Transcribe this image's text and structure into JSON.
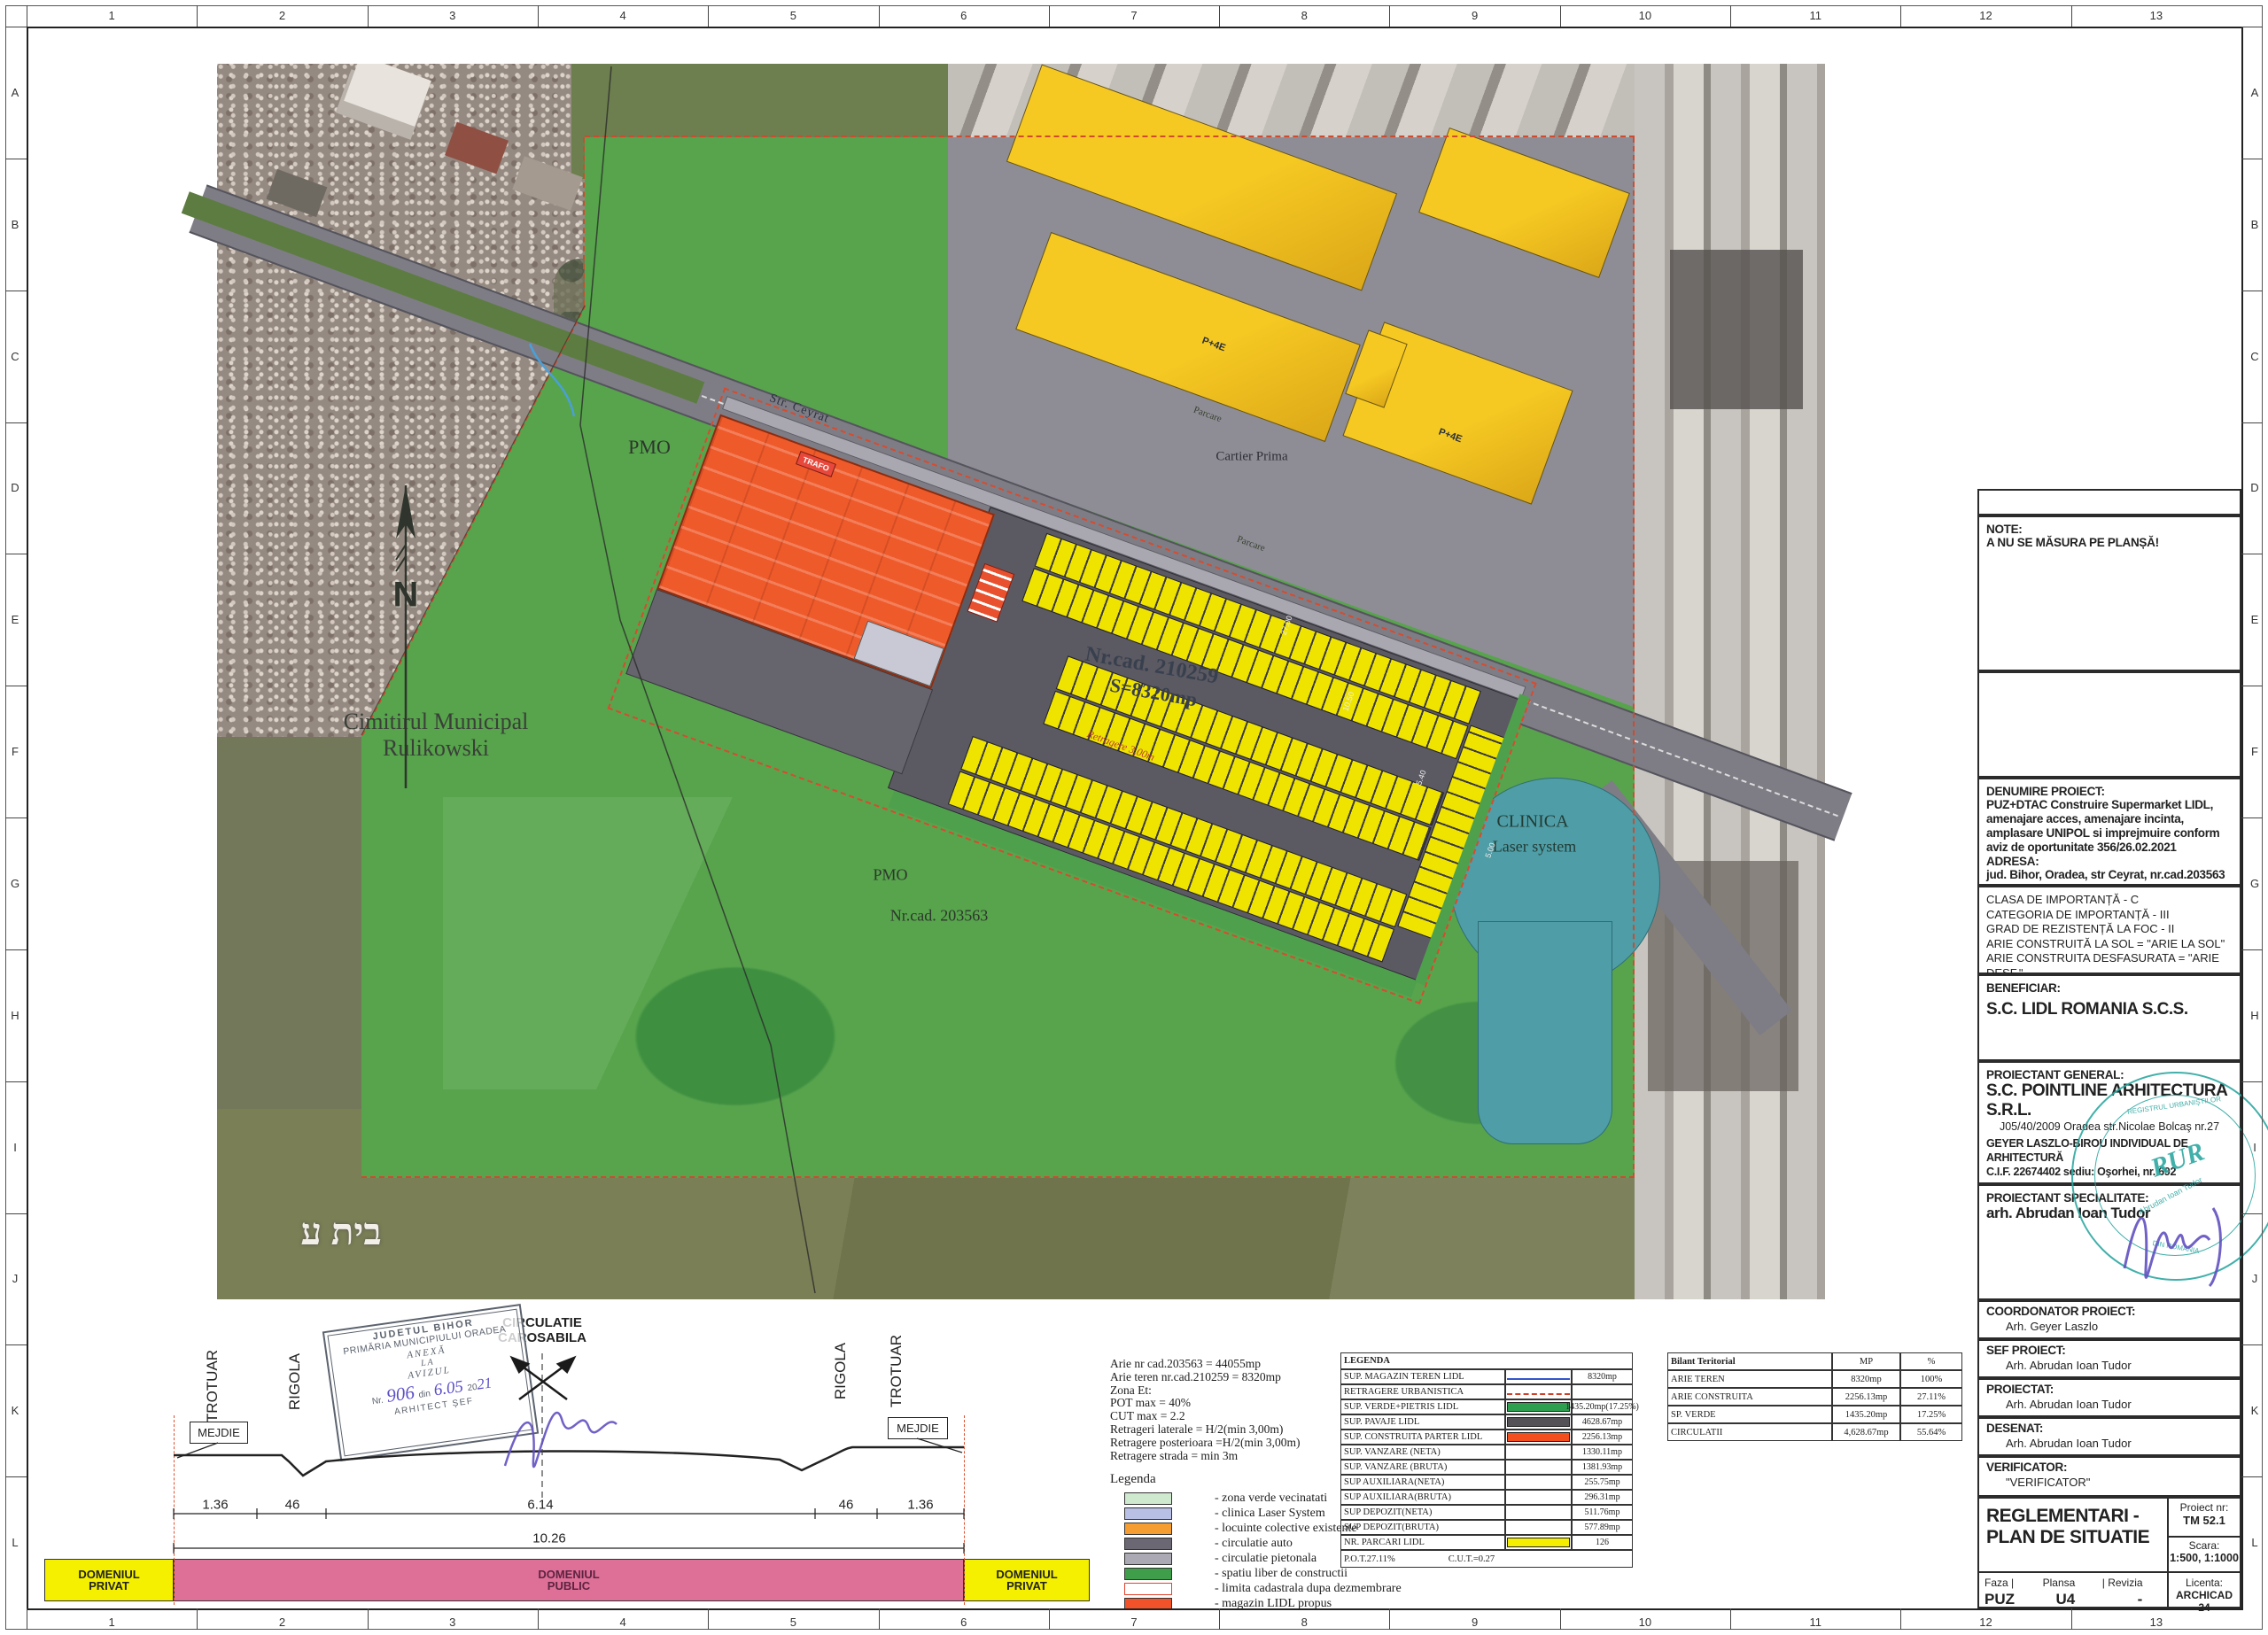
{
  "frame": {
    "columns": [
      "1",
      "2",
      "3",
      "4",
      "5",
      "6",
      "7",
      "8",
      "9",
      "10",
      "11",
      "12",
      "13"
    ],
    "rows": [
      "A",
      "B",
      "C",
      "D",
      "E",
      "F",
      "G",
      "H",
      "I",
      "J",
      "K",
      "L"
    ]
  },
  "note": {
    "title": "NOTE:",
    "body": "A NU SE MĂSURA PE PLANȘĂ!"
  },
  "project": {
    "heading": "DENUMIRE PROIECT:",
    "description": "PUZ+DTAC Construire Supermarket LIDL, amenajare acces, amenajare incinta, amplasare UNIPOL si imprejmuire conform aviz de oportunitate 356/26.02.2021",
    "address_heading": "ADRESA:",
    "address": "jud. Bihor, Oradea, str Ceyrat, nr.cad.203563"
  },
  "importance": {
    "lines": [
      "CLASA DE IMPORTANȚĂ - C",
      "CATEGORIA DE IMPORTANȚĂ - III",
      "GRAD DE REZISTENȚĂ LA FOC - II",
      "ARIE CONSTRUITĂ LA SOL = \"ARIE LA SOL\"",
      "ARIE CONSTRUITA DESFASURATA = \"ARIE DESF.\""
    ]
  },
  "beneficiar": {
    "heading": "BENEFICIAR:",
    "name": "S.C. LIDL ROMANIA S.C.S."
  },
  "proiectant_general": {
    "heading": "PROIECTANT GENERAL:",
    "name": "S.C. POINTLINE ARHITECTURA S.R.L.",
    "reg": "J05/40/2009 Oradea str.Nicolae Bolcaş nr.27",
    "line2": "GEYER LASZLO-BIROU INDIVIDUAL DE ARHITECTURĂ",
    "line3": "C.I.F. 22674402 sediu: Oşorhei, nr. 692"
  },
  "proiectant_specialitate": {
    "heading": "PROIECTANT SPECIALITATE:",
    "name": "arh. Abrudan Ioan Tudor"
  },
  "roles": [
    {
      "heading": "COORDONATOR PROIECT:",
      "name": "Arh. Geyer Laszlo"
    },
    {
      "heading": "SEF PROIECT:",
      "name": "Arh. Abrudan Ioan Tudor"
    },
    {
      "heading": "PROIECTAT:",
      "name": "Arh. Abrudan Ioan Tudor"
    },
    {
      "heading": "DESENAT:",
      "name": "Arh. Abrudan Ioan Tudor"
    },
    {
      "heading": "VERIFICATOR:",
      "name": "\"VERIFICATOR\""
    }
  ],
  "titleblock": {
    "title": "REGLEMENTARI - PLAN DE SITUATIE",
    "proiect_label": "Proiect  nr:",
    "proiect_nr": "TM 52.1",
    "scara_label": "Scara:",
    "scara": "1:500, 1:1000",
    "faza_label": "Faza  |",
    "faza": "PUZ",
    "plansa_label": "Plansa",
    "plansa": "U4",
    "revizia_label": "|  Revizia",
    "revizia": "-",
    "licenta_label": "Licenta:",
    "licenta": "ARCHICAD 24"
  },
  "parameters": {
    "lines": [
      "Arie nr cad.203563 = 44055mp",
      "Arie teren nr.cad.210259 = 8320mp",
      "Zona Et:",
      "POT max = 40%",
      "CUT max = 2.2",
      "Retrageri laterale = H/2(min 3,00m)",
      "Retragere posterioara =H/2(min 3,00m)",
      "Retragere strada = min 3m"
    ]
  },
  "legenda_table": {
    "header": "LEGENDA",
    "rows": [
      {
        "label": "SUP. MAGAZIN TEREN LIDL",
        "swatch": "blue-line",
        "value": "8320mp"
      },
      {
        "label": "RETRAGERE URBANISTICA",
        "swatch": "red-dash",
        "value": ""
      },
      {
        "label": "SUP. VERDE+PIETRIS LIDL",
        "swatch": "green-fill",
        "value": "1435.20mp(17.25%)"
      },
      {
        "label": "SUP. PAVAJE LIDL",
        "swatch": "gray-fill",
        "value": "4628.67mp"
      },
      {
        "label": "SUP. CONSTRUITA PARTER LIDL",
        "swatch": "orange-fill",
        "value": "2256.13mp"
      },
      {
        "label": "SUP. VANZARE (NETA)",
        "swatch": "none",
        "value": "1330.11mp"
      },
      {
        "label": "SUP. VANZARE (BRUTA)",
        "swatch": "none",
        "value": "1381.93mp"
      },
      {
        "label": "SUP AUXILIARA(NETA)",
        "swatch": "none",
        "value": "255.75mp"
      },
      {
        "label": "SUP AUXILIARA(BRUTA)",
        "swatch": "none",
        "value": "296.31mp"
      },
      {
        "label": "SUP DEPOZIT(NETA)",
        "swatch": "none",
        "value": "511.76mp"
      },
      {
        "label": "SUP DEPOZIT(BRUTA)",
        "swatch": "none",
        "value": "577.89mp"
      },
      {
        "label": "NR. PARCARI LIDL",
        "swatch": "yellow-fill",
        "value": "126"
      }
    ],
    "footer_pot": "P.O.T.27.11%",
    "footer_cut": "C.U.T.=0.27"
  },
  "bilant": {
    "title": "Bilant Teritorial",
    "col_mp": "MP",
    "col_pct": "%",
    "rows": [
      {
        "label": "ARIE TEREN",
        "mp": "8320mp",
        "pct": "100%"
      },
      {
        "label": "ARIE CONSTRUITA",
        "mp": "2256.13mp",
        "pct": "27.11%"
      },
      {
        "label": "SP. VERDE",
        "mp": "1435.20mp",
        "pct": "17.25%"
      },
      {
        "label": "CIRCULATII",
        "mp": "4,628.67mp",
        "pct": "55.64%"
      }
    ]
  },
  "legenda_swatches": {
    "title": "Legenda",
    "items": [
      {
        "color": "#cfe9cf",
        "label": "- zona verde vecinatati"
      },
      {
        "color": "#b9c0e6",
        "label": "- clinica Laser System"
      },
      {
        "color": "#f59d31",
        "label": "- locuinte colective existente"
      },
      {
        "color": "#6b6873",
        "label": "- circulatie auto"
      },
      {
        "color": "#abaab4",
        "label": "- circulatie pietonala"
      },
      {
        "color": "#3f9e4a",
        "label": "- spatiu liber de constructii"
      },
      {
        "color": "#ffffff",
        "label": "- limita cadastrala dupa dezmembrare"
      },
      {
        "color": "#f2522a",
        "label": "- magazin LIDL propus"
      }
    ]
  },
  "section": {
    "trotuar": "TROTUAR",
    "rigola": "RIGOLA",
    "circulatie": "CIRCULATIE\nCAROSABILA",
    "mejdie": "MEJDIE",
    "dims": [
      "1.36",
      "46",
      "6.14",
      "46",
      "1.36"
    ],
    "total": "10.26",
    "dom_privat": "DOMENIUL\nPRIVAT",
    "dom_public": "DOMENIUL\nPUBLIC"
  },
  "aviz_stamp": {
    "line1": "JUDETUL BIHOR",
    "line2": "PRIMĂRIA MUNICIPIULUI ORADEA",
    "line3": "ANEXĂ",
    "line4": "LA",
    "line5": "AVIZUL",
    "nr_label": "Nr.",
    "nr_value": "906",
    "din_label": "din",
    "din_value": "6.05",
    "year_prefix": "20",
    "year_hand": "21",
    "footer": "ARHITECT ȘEF"
  },
  "rur_stamp": {
    "top": "REGISTRUL URBANIŞTILOR",
    "bottom": "DIN ROMÂNIA",
    "name": "Abrudan Ioan Tudor",
    "code": "RUR"
  },
  "map": {
    "north": "N",
    "cemetery": "Cimitirul Municipal\nRulikowski",
    "hebrew": "בית ע",
    "pmo1": "PMO",
    "pmo2": "PMO",
    "cad1": "Nr.cad. 203563",
    "cad2": "Nr.cad. 210259",
    "cad2b": "S=8320mp",
    "cartier": "Cartier Prima",
    "parcare1": "Parcare",
    "parcare2": "Parcare",
    "pe4a": "P+4E",
    "pe4b": "P+4E",
    "street": "Str. Ceyrat",
    "trafo": "TRAFO",
    "clinica": "CLINICA",
    "clinica2": "Laser system",
    "retragere": "Retragere 3,00m",
    "dimension_marks": [
      "27.00",
      "10.50",
      "5.40",
      "5.00"
    ]
  },
  "colors": {
    "lidl_orange": "#ef5a2b",
    "parking_yellow": "#efe400",
    "overlay_green": "#57a44c",
    "cartier_gray": "#8e8d96",
    "clinic_teal": "#4f9da6",
    "domeniul_pink": "#de6f97",
    "domeniul_yellow": "#f4f000",
    "stamp_teal": "#2ea8a1",
    "handwriting_blue": "#5a4fc8",
    "redline": "#cf4a2f"
  }
}
